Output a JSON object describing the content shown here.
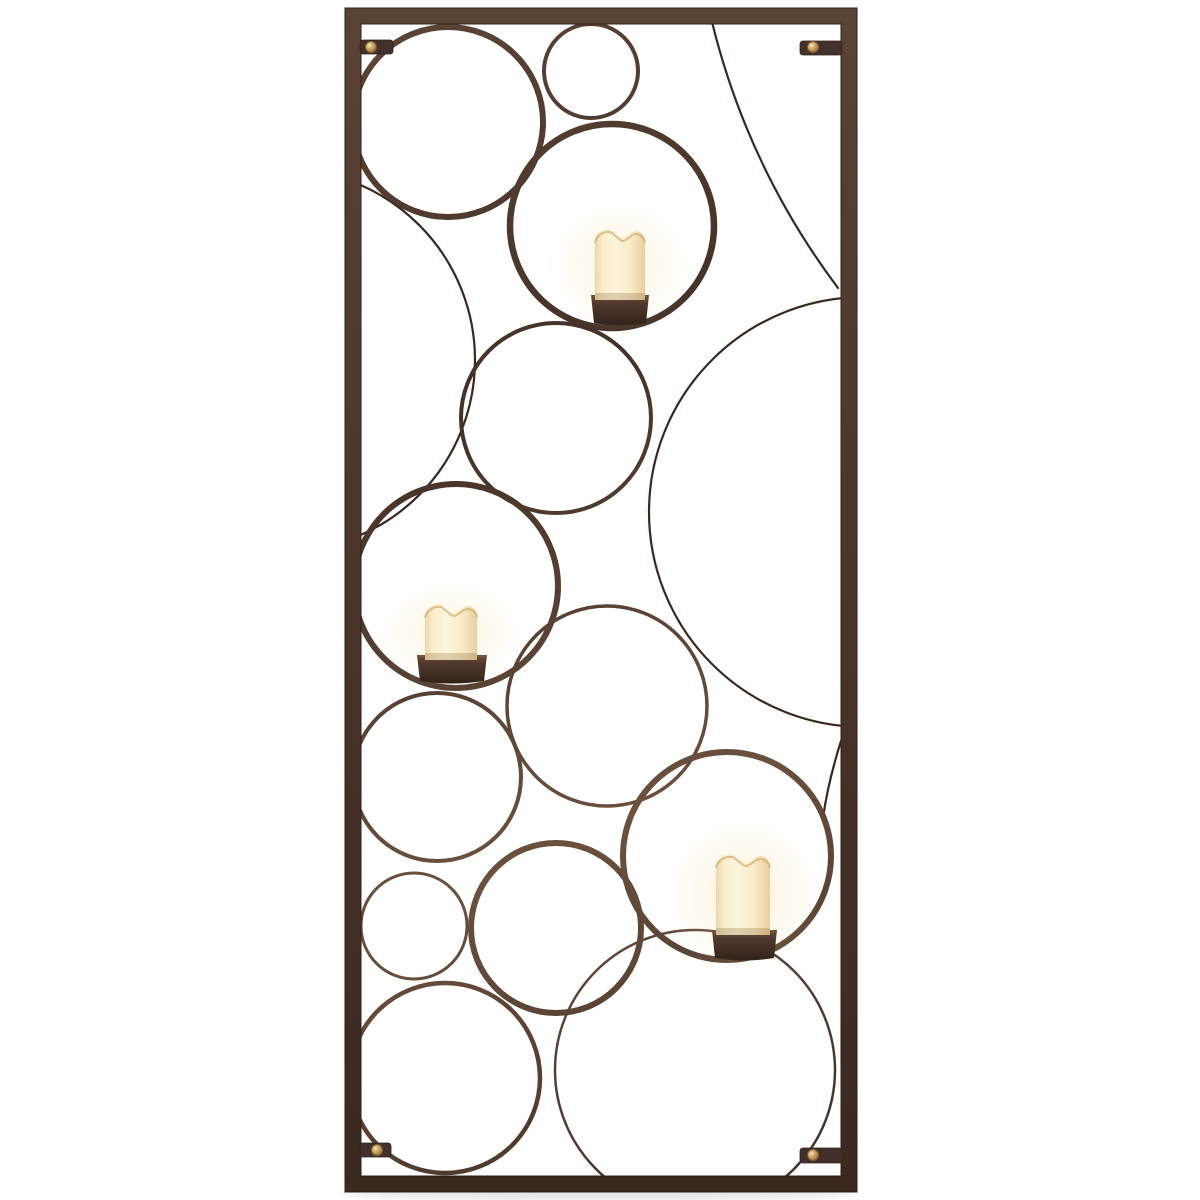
{
  "scene": {
    "description": "Product photo on white background: tall rectangular bronze metal wall sconce made of overlapping open circles of various sizes, holding three cream flameless pillar candles in dark metal cup holders, with four brass-screw wall mounting tabs",
    "background_color": "#ffffff"
  },
  "frame": {
    "x": 345,
    "y": 8,
    "width": 512,
    "height": 1184,
    "thickness": 16
  },
  "palette": {
    "frame_stops": [
      "#5a4234",
      "#4a342a",
      "#3a291f"
    ],
    "frame_edge": "#2f211a",
    "ring_stops": [
      "#5e4636",
      "#443127",
      "#6b503d",
      "#3e2c23"
    ],
    "wire": "#3a2820",
    "bracket": "#44302a",
    "screw_face": "#c49a55",
    "screw_edge": "#7c5c2e",
    "screw_highlight": "#ecd9a8",
    "candle_stops": [
      "#eed7ae",
      "#f9edcc",
      "#fdf5dc",
      "#f8ebc8",
      "#e9cf9f"
    ],
    "candle_rim": "#d3a96f",
    "wax_shadow": "rgba(130,90,45,0.25)",
    "holder_stops": [
      "#6b4d3b",
      "#4f382c",
      "#32221a"
    ],
    "holder_rim": "#7a5a44",
    "glow": "#ffe09b",
    "drop_shadow": "#000000"
  },
  "rings": [
    {
      "cx": 448,
      "cy": 122,
      "r": 95,
      "sw": 6
    },
    {
      "cx": 591,
      "cy": 71,
      "r": 47,
      "sw": 4
    },
    {
      "cx": 612,
      "cy": 226,
      "r": 102,
      "sw": 6.5
    },
    {
      "cx": 556,
      "cy": 418,
      "r": 95,
      "sw": 4
    },
    {
      "cx": 456,
      "cy": 586,
      "r": 102,
      "sw": 6
    },
    {
      "cx": 607,
      "cy": 706,
      "r": 100,
      "sw": 3.5
    },
    {
      "cx": 437,
      "cy": 777,
      "r": 84,
      "sw": 4
    },
    {
      "cx": 414,
      "cy": 926,
      "r": 53,
      "sw": 3
    },
    {
      "cx": 556,
      "cy": 928,
      "r": 85,
      "sw": 6
    },
    {
      "cx": 445,
      "cy": 1078,
      "r": 95,
      "sw": 4.5
    },
    {
      "cx": 727,
      "cy": 856,
      "r": 104,
      "sw": 6
    },
    {
      "cx": 695,
      "cy": 1070,
      "r": 140,
      "sw": 2.5
    }
  ],
  "wires": [
    {
      "kind": "circle",
      "cx": 284,
      "cy": 360,
      "r": 191
    },
    {
      "kind": "circle",
      "cx": 864,
      "cy": 512,
      "r": 215
    },
    {
      "kind": "path",
      "d": "M712,22 Q748,168 838,288"
    },
    {
      "kind": "path",
      "d": "M841,741 Q828,782 823,818"
    }
  ],
  "candles": [
    {
      "x": 595,
      "w": 50,
      "top": 229,
      "glow": 0.5,
      "holder": {
        "x": 591,
        "y": 295,
        "w": 58,
        "h": 28
      }
    },
    {
      "x": 425,
      "w": 52,
      "top": 604,
      "glow": 0.5,
      "holder": {
        "x": 417,
        "y": 655,
        "w": 70,
        "h": 26
      }
    },
    {
      "x": 716,
      "w": 54,
      "top": 854,
      "glow": 0.65,
      "holder": {
        "x": 712,
        "y": 930,
        "w": 65,
        "h": 28
      }
    }
  ],
  "brackets": [
    {
      "x": 360,
      "y": 40,
      "w": 33,
      "h": 14,
      "screw": {
        "cx": 371,
        "cy": 47,
        "r": 5.5
      }
    },
    {
      "x": 800,
      "y": 41,
      "w": 42,
      "h": 14,
      "screw": {
        "cx": 813,
        "cy": 47,
        "r": 5.5
      }
    },
    {
      "x": 360,
      "y": 1143,
      "w": 31,
      "h": 14,
      "screw": {
        "cx": 377,
        "cy": 1150,
        "r": 5.5
      }
    },
    {
      "x": 800,
      "y": 1148,
      "w": 42,
      "h": 15,
      "screw": {
        "cx": 813,
        "cy": 1155,
        "r": 5.5
      }
    }
  ]
}
